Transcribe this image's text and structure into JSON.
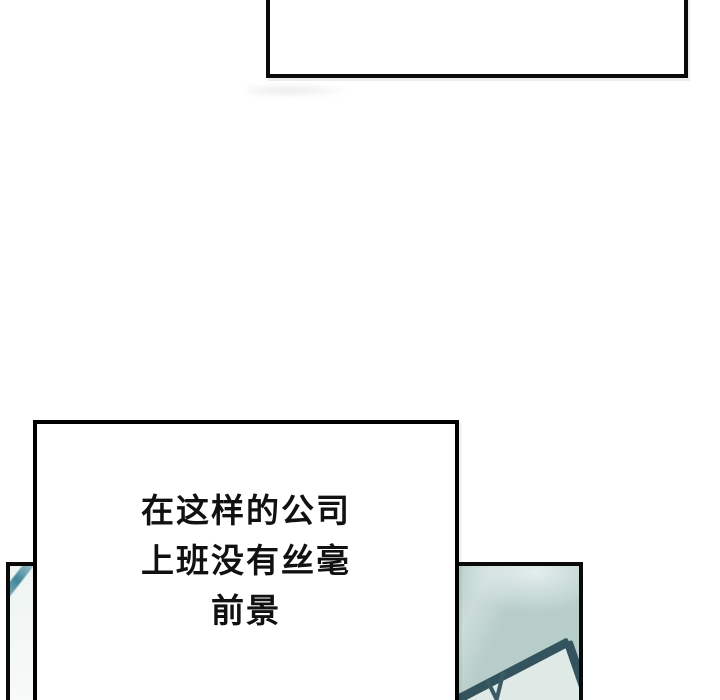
{
  "page": {
    "kind": "webtoon-comic-strip",
    "background": "#ffffff"
  },
  "colors": {
    "panel_border": "#0a0a0a",
    "bubble_border": "#000000",
    "bubble_fill": "#ffffff",
    "text": "#111111",
    "artwork_light_bg": "#f2f7f5",
    "artwork_teal_wall": "#b6cdc9",
    "backboard_frame": "#33535e",
    "backboard_inner": "#dfe9e6",
    "teal_stripe": "#41869a"
  },
  "top_panel": {
    "content": ""
  },
  "bottom_panel": {
    "artwork": "teal wall with basketball backboard corner seen from below, mostly hidden behind speech box"
  },
  "speech": {
    "lines": [
      "在这样的公司",
      "上班没有丝毫",
      "前景"
    ]
  }
}
